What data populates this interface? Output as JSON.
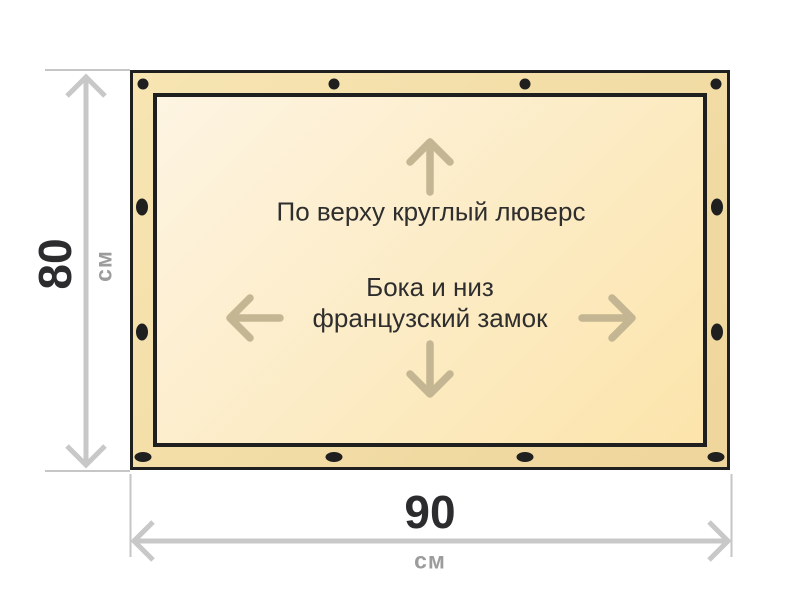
{
  "banner": {
    "labels": {
      "top_note": "По верху круглый люверс",
      "side_note_line1": "Бока и низ",
      "side_note_line2": "французский замок"
    },
    "colors": {
      "edge_strip": "#f3dca4",
      "inner_fill_start": "#fdf4e2",
      "inner_fill_end": "#fce4ab",
      "outline": "#1f1f1f",
      "grommet": "#1f1f1f",
      "direction_arrow": "#c4b692",
      "note_text": "#2e2e2e"
    }
  },
  "dimensions": {
    "height": {
      "value": "80",
      "unit": "см"
    },
    "width": {
      "value": "90",
      "unit": "см"
    },
    "colors": {
      "arrow_line": "#c8c8c8",
      "extension_line": "#c6c6c6",
      "value_text": "#2c2c2e",
      "unit_text": "#9c9c9c"
    }
  }
}
